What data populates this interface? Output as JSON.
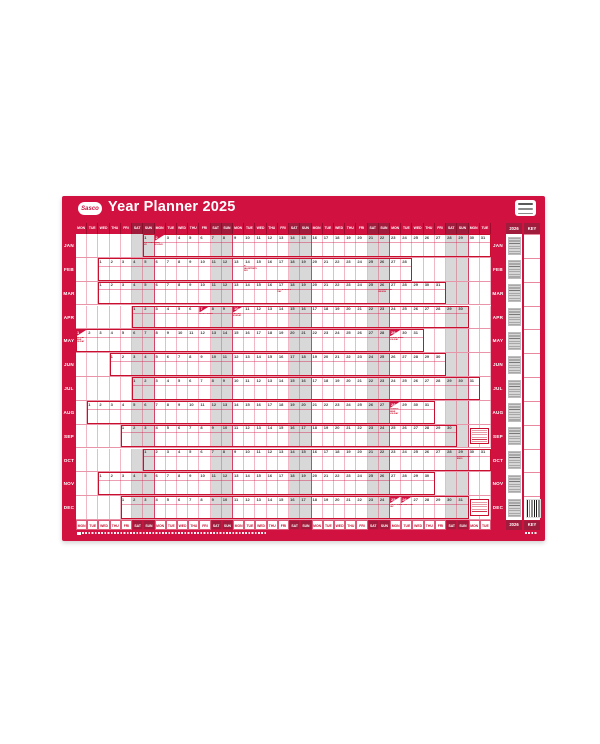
{
  "planner": {
    "brand": "Sasco",
    "title": "Year Planner 2025",
    "colors": {
      "main_red": "#d11240",
      "weekend_dark_red": "#a01c3c",
      "outline_red": "#c8102e",
      "weekend_gray": "#d8d8d8",
      "number_gray": "#3c3c3c",
      "page_background": "#ffffff"
    },
    "day_headers": [
      "MON",
      "TUE",
      "WED",
      "THU",
      "FRI",
      "SAT",
      "SUN"
    ],
    "grid_columns": 37,
    "months": [
      {
        "name": "JAN",
        "start_col": 7,
        "days": 31
      },
      {
        "name": "FEB",
        "start_col": 3,
        "days": 28
      },
      {
        "name": "MAR",
        "start_col": 3,
        "days": 31
      },
      {
        "name": "APR",
        "start_col": 6,
        "days": 30
      },
      {
        "name": "MAY",
        "start_col": 1,
        "days": 31
      },
      {
        "name": "JUN",
        "start_col": 4,
        "days": 30
      },
      {
        "name": "JUL",
        "start_col": 6,
        "days": 31
      },
      {
        "name": "AUG",
        "start_col": 2,
        "days": 31
      },
      {
        "name": "SEP",
        "start_col": 5,
        "days": 30
      },
      {
        "name": "OCT",
        "start_col": 7,
        "days": 31
      },
      {
        "name": "NOV",
        "start_col": 3,
        "days": 30
      },
      {
        "name": "DEC",
        "start_col": 5,
        "days": 31
      }
    ],
    "events": [
      {
        "month": 0,
        "day": 1,
        "type": "note",
        "label": "NEW YEAR'S DAY"
      },
      {
        "month": 0,
        "day": 2,
        "type": "holiday",
        "label": "BANK HOLIDAY"
      },
      {
        "month": 1,
        "day": 14,
        "type": "note",
        "label": "ST VALENTINE'S DAY"
      },
      {
        "month": 2,
        "day": 17,
        "type": "note",
        "label": "ST PATRICK'S DAY"
      },
      {
        "month": 2,
        "day": 26,
        "type": "note",
        "label": "SUMMERTIME BEGINS"
      },
      {
        "month": 3,
        "day": 7,
        "type": "holiday",
        "label": "GOOD FRIDAY"
      },
      {
        "month": 3,
        "day": 10,
        "type": "holiday",
        "label": "EASTER MONDAY"
      },
      {
        "month": 4,
        "day": 1,
        "type": "holiday",
        "label": "MAY DAY BANK HOLIDAY"
      },
      {
        "month": 4,
        "day": 29,
        "type": "holiday",
        "label": "SPRING BANK HOLIDAY"
      },
      {
        "month": 7,
        "day": 28,
        "type": "holiday",
        "label": "SUMMER BANK HOLIDAY"
      },
      {
        "month": 9,
        "day": 29,
        "type": "note",
        "label": "SUMMERTIME ENDS"
      },
      {
        "month": 11,
        "day": 25,
        "type": "holiday",
        "label": "CHRISTMAS DAY"
      },
      {
        "month": 11,
        "day": 26,
        "type": "holiday",
        "label": "BOXING DAY"
      }
    ],
    "note_box_rows": [
      8,
      11
    ],
    "right_panel": {
      "year_label": "2026",
      "key_label": "KEY"
    }
  }
}
